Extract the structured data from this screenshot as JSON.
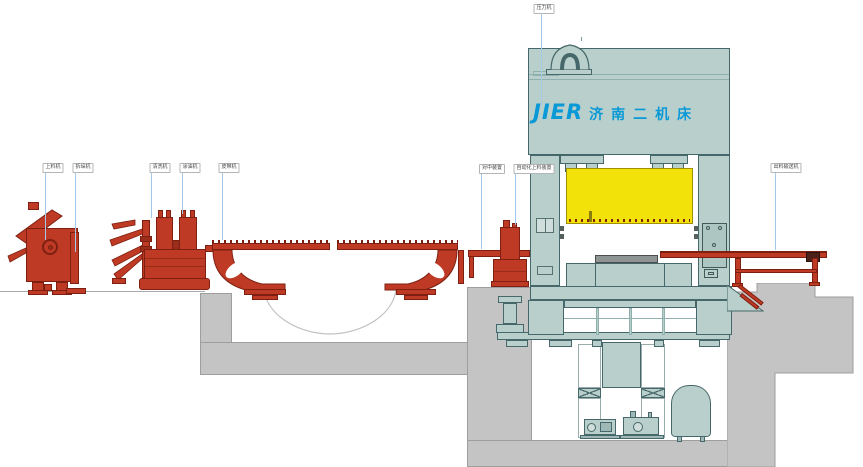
{
  "diagram": {
    "type": "press-line-side-elevation",
    "brand": {
      "latin": "JIER",
      "chinese": "济南二机床",
      "logo_color": "#0899d6"
    },
    "labels": [
      {
        "id": "feeder",
        "text": "上料机"
      },
      {
        "id": "destacker",
        "text": "拆垛机"
      },
      {
        "id": "washer",
        "text": "清洗机"
      },
      {
        "id": "oiler",
        "text": "涂油机"
      },
      {
        "id": "belt-conveyor",
        "text": "皮带机"
      },
      {
        "id": "centering",
        "text": "对中装置"
      },
      {
        "id": "loading-device",
        "text": "自动化上料装置"
      },
      {
        "id": "press",
        "text": "压力机"
      },
      {
        "id": "exit-conveyor",
        "text": "出料输送机"
      }
    ],
    "colors": {
      "equipment_red": "#bf3a24",
      "press_teal": "#b9cfcb",
      "slide_window_yellow": "#f2e20a",
      "concrete_gray": "#c4c4c4",
      "leader_blue": "#a5c9e9",
      "die_slab_gray": "#8f9494",
      "background": "#ffffff"
    }
  }
}
